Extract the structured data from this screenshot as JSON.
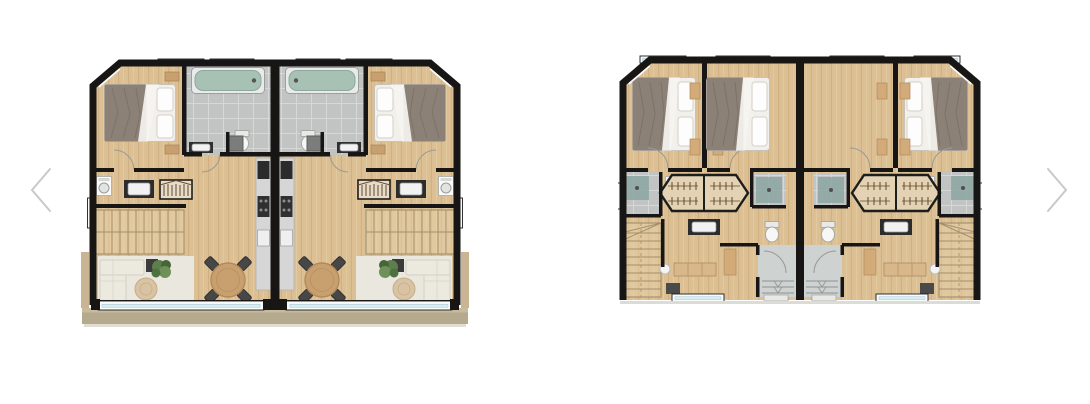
{
  "carousel": {
    "prev_icon": "chevron-left",
    "next_icon": "chevron-right",
    "prev_label": "Previous",
    "next_label": "Next"
  },
  "plans": [
    {
      "label": "Floor plan — living level of mirrored duplex"
    },
    {
      "label": "Floor plan — bedroom level of mirrored duplex"
    }
  ],
  "palette": {
    "bg": "#ffffff",
    "wall": "#171614",
    "wood": "#dcc094",
    "wood_line": "#cbab7c",
    "wood_hi": "#e7d2aa",
    "tile": "#c1c4c3",
    "tile_line": "#d6d8d7",
    "tile_light": "#ced2d1",
    "glass": "#d8eef5",
    "frame_white": "#fbfbfb",
    "water": "#a7c1b5",
    "blanket": "#8b8177",
    "sheet": "#f2f0ea",
    "sofa": "#eceadf",
    "rug": "#eae7df",
    "jute": "#d9c3a2",
    "plant": "#5d7f4b",
    "plant_dark": "#46663a",
    "table_wood": "#c89f6e",
    "chair": "#474747",
    "counter": "#d6d6d6",
    "appliance": "#2b2b2b",
    "terrace": "#b5aa8e",
    "terrace_hi": "#c6bb9f",
    "arrow": "#c9c9c9",
    "shower_glass": "#8ba6a1"
  }
}
